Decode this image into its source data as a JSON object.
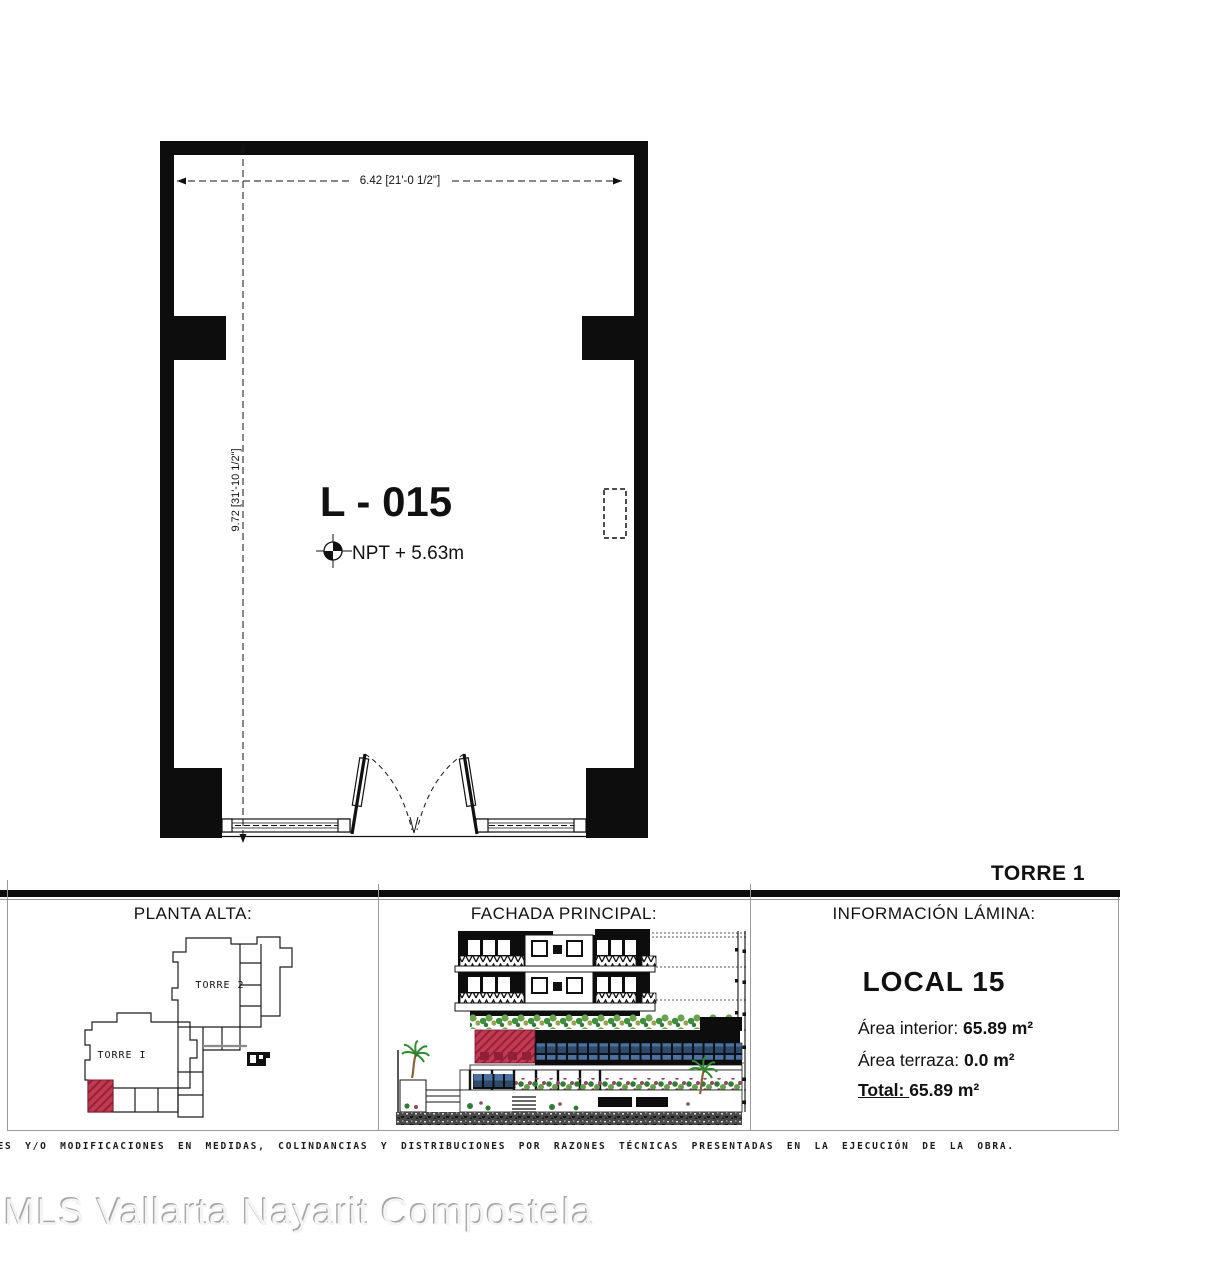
{
  "sheet": {
    "unit_label": "L - 015",
    "npt_label": "NPT + 5.63m",
    "dim_width": "6.42 [21'-0 1/2\"]",
    "dim_height": "9.72 [31'-10 1/2\"]",
    "tower_header": "TORRE 1"
  },
  "panels": {
    "planta_alta": {
      "title": "PLANTA ALTA:",
      "torre1_label": "TORRE I",
      "torre2_label": "TORRE 2"
    },
    "fachada": {
      "title": "FACHADA PRINCIPAL:"
    },
    "info": {
      "title": "INFORMACIÓN LÁMINA:",
      "local": "LOCAL 15",
      "rows": [
        {
          "label": "Área interior:",
          "value": "65.89 m²"
        },
        {
          "label": "Área terraza:",
          "value": "0.0 m²"
        },
        {
          "label": "Total:",
          "value": "65.89 m²"
        }
      ]
    }
  },
  "disclaimer": "TES Y/O MODIFICACIONES EN MEDIDAS, COLINDANCIAS Y DISTRIBUCIONES POR RAZONES TÉCNICAS PRESENTADAS EN LA EJECUCIÓN DE LA OBRA.",
  "watermark": "MLS Vallarta Nayarit Compostela",
  "colors": {
    "highlight_red": "#c23b50",
    "window_blue": "#4c70a0"
  }
}
